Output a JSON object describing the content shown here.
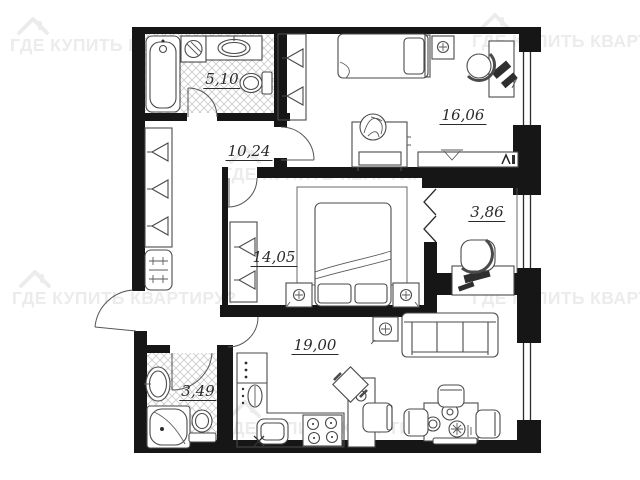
{
  "watermark": {
    "text": "ГДЕ КУПИТЬ КВАРТИРУ?",
    "color": "#ececec",
    "icon": "house-icon"
  },
  "plan": {
    "rooms": [
      {
        "name": "bathroom-top",
        "label": "5,10"
      },
      {
        "name": "hallway",
        "label": "10,24"
      },
      {
        "name": "bedroom-right",
        "label": "16,06"
      },
      {
        "name": "balcony",
        "label": "3,86"
      },
      {
        "name": "bedroom-middle",
        "label": "14,05"
      },
      {
        "name": "kitchen-living",
        "label": "19,00"
      },
      {
        "name": "bathroom-bottom",
        "label": "3,49"
      }
    ],
    "colors": {
      "walls": "#161616",
      "furniture_stroke": "#4a4a4a",
      "hatch": "#c9c9c9",
      "label_text": "#2a2a2a",
      "background": "#ffffff"
    },
    "fixtures": [
      "bathtub",
      "washing-machine",
      "vanity-sink",
      "toilet",
      "shower",
      "wardrobe",
      "shoe-cabinet",
      "single-bed",
      "double-bed",
      "nightstand",
      "lamp",
      "desk",
      "office-chair",
      "chair",
      "dresser",
      "plant",
      "tv-stand",
      "sofa",
      "side-table",
      "kitchen-cabinet",
      "boiler",
      "kitchen-sink",
      "stove",
      "dining-table",
      "balcony-chair",
      "balcony-desk",
      "accordion-door"
    ]
  }
}
